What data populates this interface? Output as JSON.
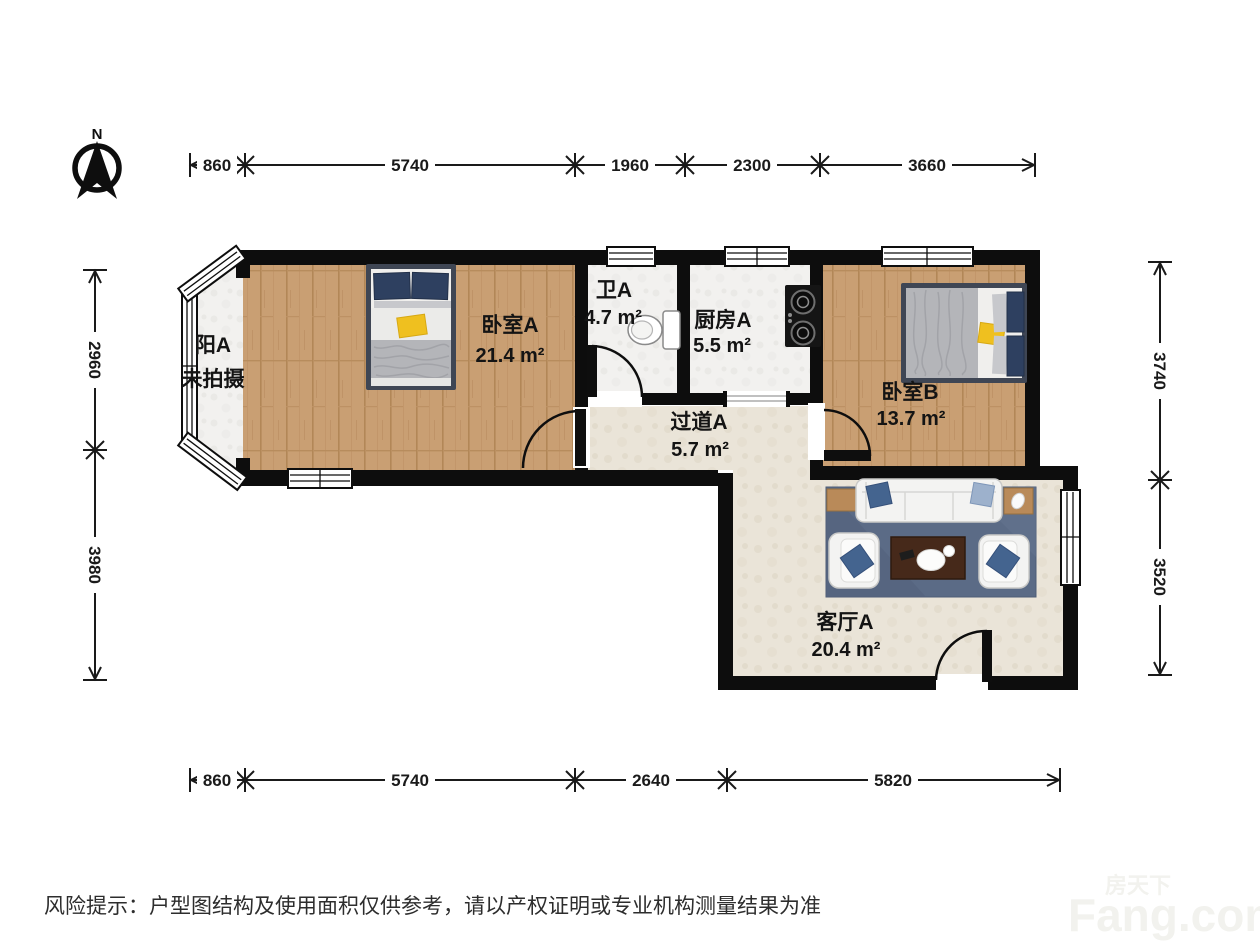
{
  "compass": {
    "label": "N"
  },
  "rooms": {
    "balcony": {
      "name": "阳A",
      "note": "未拍摄"
    },
    "bedroom_a": {
      "name": "卧室A",
      "area": "21.4 m²"
    },
    "bath_a": {
      "name": "卫A",
      "area": "4.7 m²"
    },
    "kitchen_a": {
      "name": "厨房A",
      "area": "5.5 m²"
    },
    "bedroom_b": {
      "name": "卧室B",
      "area": "13.7 m²"
    },
    "hallway_a": {
      "name": "过道A",
      "area": "5.7 m²"
    },
    "living_a": {
      "name": "客厅A",
      "area": "20.4 m²"
    }
  },
  "dimensions": {
    "top": [
      "860",
      "5740",
      "1960",
      "2300",
      "3660"
    ],
    "bottom": [
      "860",
      "5740",
      "2640",
      "5820"
    ],
    "left": [
      "2960",
      "3980"
    ],
    "right": [
      "3740",
      "3520"
    ]
  },
  "footer": {
    "disclaimer": "风险提示：户型图结构及使用面积仅供参考，请以产权证明或专业机构测量结果为准"
  },
  "watermark": {
    "brand_cn": "房天下",
    "brand_en": "Fang.com"
  },
  "colors": {
    "wall": "#0d0d0d",
    "wood_floor": "#c99f73",
    "tile_floor": "#f2f1ef",
    "beige_floor": "#eae4d8",
    "rug": "#5b6b86",
    "pillow_navy": "#2e4060",
    "pillow_blue": "#44648f",
    "accent_yellow": "#efc01f",
    "table_brown": "#46291a"
  }
}
